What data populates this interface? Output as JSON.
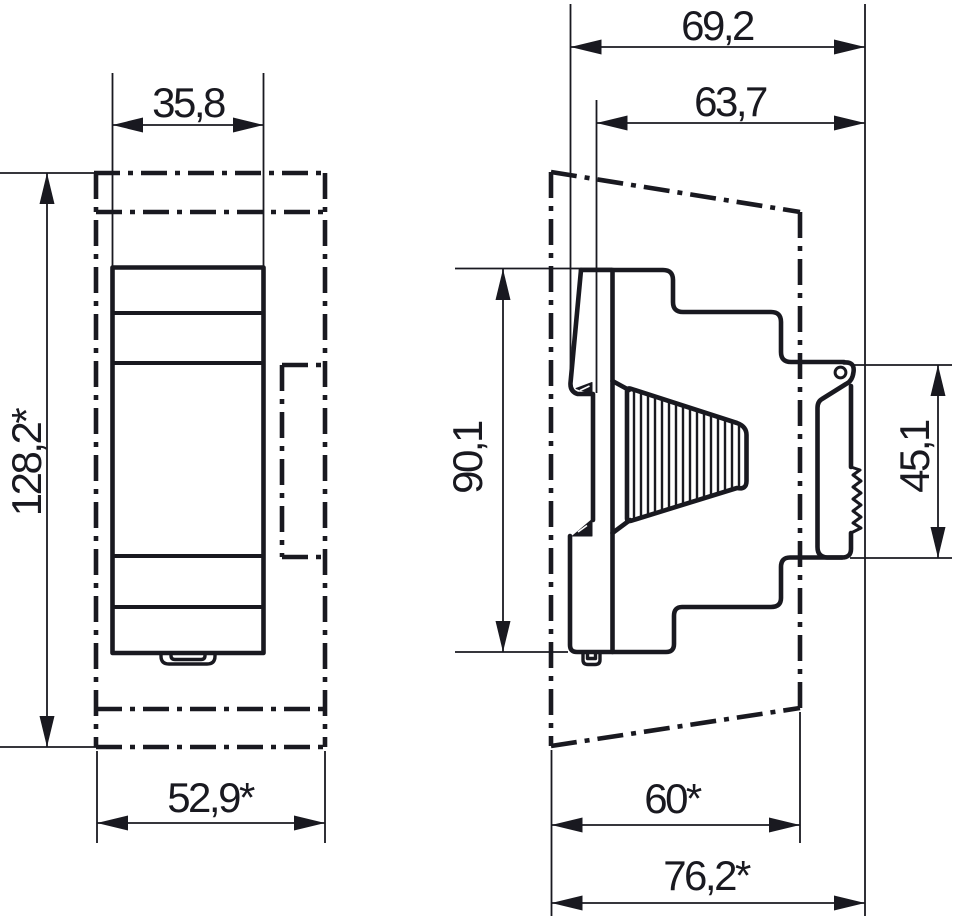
{
  "page": {
    "background": "#ffffff",
    "line_color": "#191920",
    "description": "Technical dimension drawing, front and side view of a DIN-rail device"
  },
  "drawing": {
    "front_view": {
      "width_label": "35,8",
      "height_label": "128,2*",
      "base_width_label": "52,9*"
    },
    "side_view": {
      "total_depth_label": "69,2",
      "body_depth_label": "63,7",
      "body_height_label": "90,1",
      "rail_section_label": "45,1",
      "lower_depth_label": "60*",
      "overall_depth_label": "76,2*"
    }
  }
}
